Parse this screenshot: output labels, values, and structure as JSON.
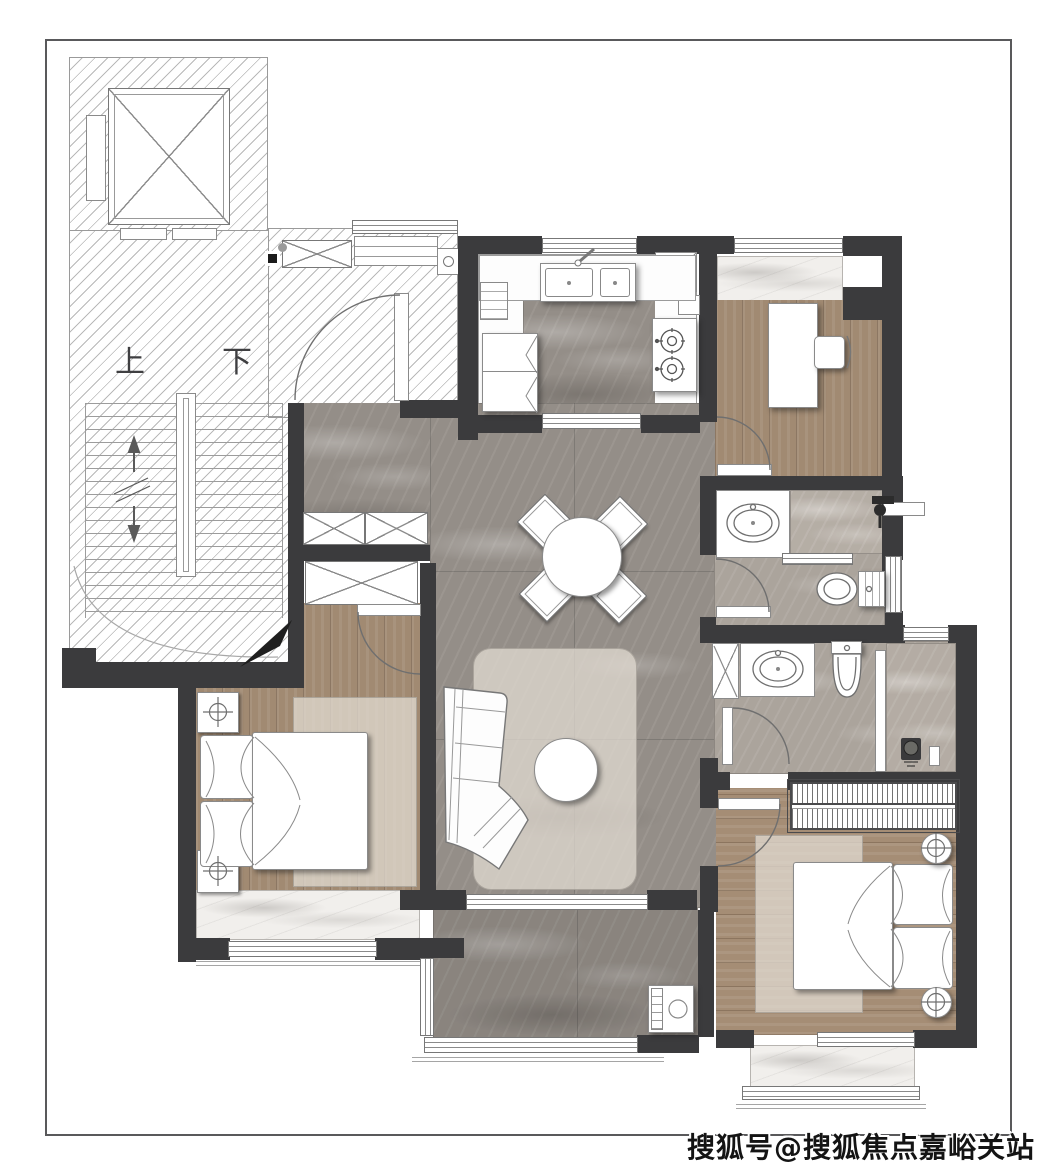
{
  "title": "residential-floor-plan",
  "labels": {
    "stairs_up": "上",
    "stairs_down": "下"
  },
  "watermark": {
    "text": "搜狐号@搜狐焦点嘉峪关站"
  },
  "palette": {
    "wall": "#3b3b3d",
    "floor_marble_gray": "#948e88",
    "floor_marble_bath": "#aba49c",
    "floor_marble_white": "#f1efec",
    "floor_wood": "#a18a72",
    "hatch_line": "#b9b9b9",
    "outline": "#8a8a8a",
    "watermark_color": "#141414"
  },
  "icons": {
    "elevator": "elevator-shaft-icon",
    "stairs": "staircase-icon",
    "entry_door": "door-swing-icon",
    "dining_table": "dining-table-icon",
    "dining_chair": "dining-chair-icon",
    "sofa": "corner-sofa-icon",
    "coffee_table": "coffee-table-icon",
    "kitchen_sink": "kitchen-sink-icon",
    "stove": "gas-stove-icon",
    "refrigerator": "refrigerator-icon",
    "washbasin": "washbasin-icon",
    "toilet": "toilet-icon",
    "shower": "shower-head-icon",
    "bed": "double-bed-icon",
    "nightstand": "nightstand-lamp-icon",
    "wardrobe": "wardrobe-icon",
    "closet": "storage-cabinet-icon",
    "desk": "desk-icon",
    "desk_chair": "chair-icon",
    "washing_machine": "washing-machine-icon",
    "window": "window-icon",
    "duct": "duct-shaft-icon"
  }
}
